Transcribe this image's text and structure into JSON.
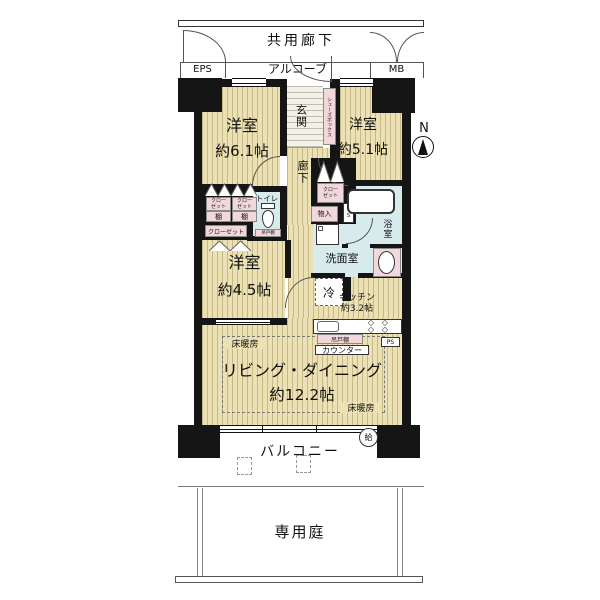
{
  "outside": {
    "common_corridor": "共用廊下",
    "eps": "EPS",
    "alcove": "アルコーブ",
    "mb": "MB",
    "balcony": "バルコニー",
    "garden": "専用庭",
    "north": "N",
    "water_heater": "給"
  },
  "rooms": {
    "bedroom1": {
      "name": "洋室",
      "size": "約6.1帖"
    },
    "bedroom2": {
      "name": "洋室",
      "size": "約5.1帖"
    },
    "bedroom3": {
      "name": "洋室",
      "size": "約4.5帖"
    },
    "living": {
      "name": "リビング・ダイニング",
      "size": "約12.2帖"
    },
    "kitchen": {
      "name": "キッチン",
      "size": "約3.2帖"
    },
    "entrance": "玄関",
    "hallway": "廊下",
    "toilet": "トイレ",
    "bath": "浴室",
    "washroom": "洗面室"
  },
  "fixtures": {
    "closet_l1": "クロー",
    "closet_l2": "ゼット",
    "closet": "クローゼット",
    "shelf": "棚",
    "shoe_box": "シューズボックス",
    "storage": "物入",
    "ps": "PS",
    "hanging_cupboard": "吊戸棚",
    "counter": "カウンター",
    "fridge": "冷",
    "floor_heating": "床暖房",
    "burner": "◇"
  },
  "colors": {
    "wall": "#151515",
    "floor": "#ECE1B4",
    "floor_stripe": "#C6B985",
    "wet_area": "#D8EBEC",
    "cabinet_pink": "#F2D8DC"
  }
}
